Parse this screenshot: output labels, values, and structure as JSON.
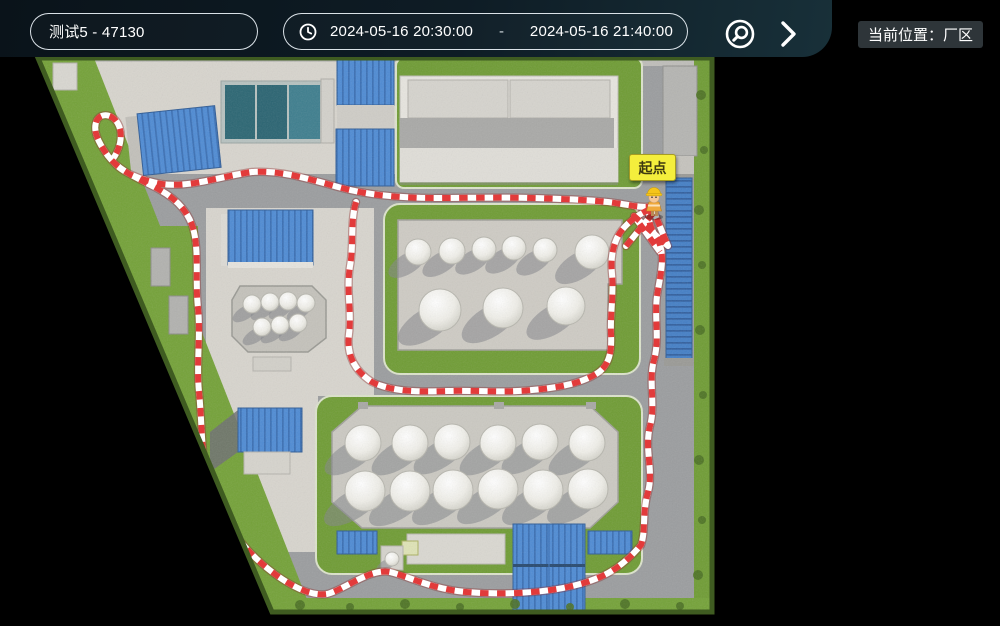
{
  "toolbar": {
    "device_select": {
      "value": "测试5 - 47130"
    },
    "time_range": {
      "icon": "clock-icon",
      "start": "2024-05-16 20:30:00",
      "separator": "-",
      "end": "2024-05-16 21:40:00"
    },
    "locate_button": {
      "icon": "locate-search-icon"
    },
    "next_button": {
      "icon": "chevron-right-icon"
    },
    "location_chip": {
      "label": "当前位置：厂区"
    }
  },
  "map": {
    "start_marker": {
      "label": "起点",
      "color": "#f4ee3c"
    },
    "worker_marker": {
      "icon": "worker-avatar-icon"
    },
    "patrol_path": {
      "tape_red": "#e23b3b",
      "tape_white": "#ffffff"
    },
    "colors": {
      "background": "#000000",
      "toolbar_panel": "#0e1c25",
      "grass": "#6f9c34",
      "road": "#9b9d9f",
      "plaza": "#d8d5ce",
      "roof_blue": "#4e8bd4",
      "tank_white": "#f4f3ee",
      "pool_teal": "#2b6673"
    }
  }
}
